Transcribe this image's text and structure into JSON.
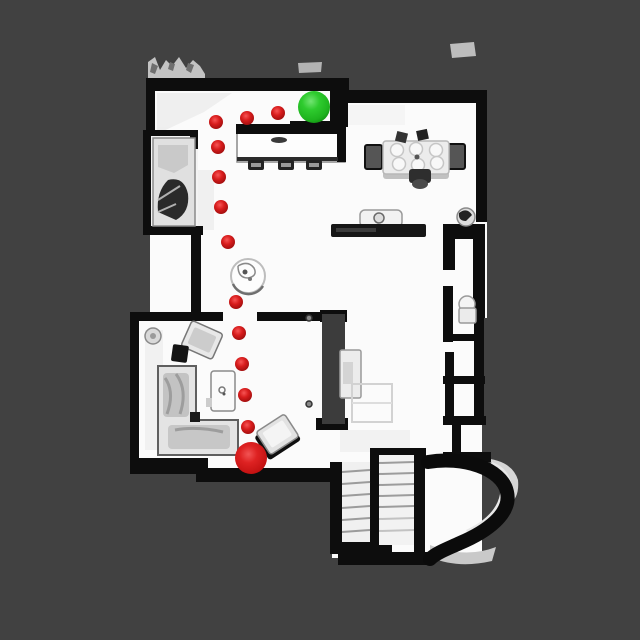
{
  "map": {
    "type": "topdown-floorplan-navigation",
    "background_color": "#414141",
    "wall_color": "#0d0d0d",
    "floor_color": "#fbfbfb",
    "markers": {
      "goal": {
        "icon": "green-sphere-icon",
        "color": "#2bc42b",
        "x": 314,
        "y": 107,
        "r": 16
      },
      "agent": {
        "icon": "red-sphere-icon",
        "color": "#d41d1d",
        "x": 251,
        "y": 458,
        "r": 16
      }
    },
    "path": {
      "color": "#cf1717",
      "dot_radius": 7,
      "waypoints": [
        [
          278,
          113
        ],
        [
          247,
          118
        ],
        [
          216,
          122
        ],
        [
          218,
          147
        ],
        [
          219,
          177
        ],
        [
          221,
          207
        ],
        [
          228,
          242
        ],
        [
          236,
          302
        ],
        [
          239,
          333
        ],
        [
          242,
          364
        ],
        [
          245,
          395
        ],
        [
          248,
          427
        ]
      ]
    },
    "rooms": {
      "kitchen_island": {
        "x": 236,
        "y": 124,
        "w": 110,
        "h": 40
      },
      "dining_table": {
        "x": 383,
        "y": 141,
        "w": 66,
        "h": 33
      },
      "round_table": {
        "cx": 248,
        "cy": 276,
        "r": 17
      },
      "living_room_sofa": {
        "x": 158,
        "y": 366,
        "w": 80,
        "h": 89
      },
      "staircase": {
        "x": 332,
        "y": 450,
        "w": 94,
        "h": 108
      }
    }
  }
}
